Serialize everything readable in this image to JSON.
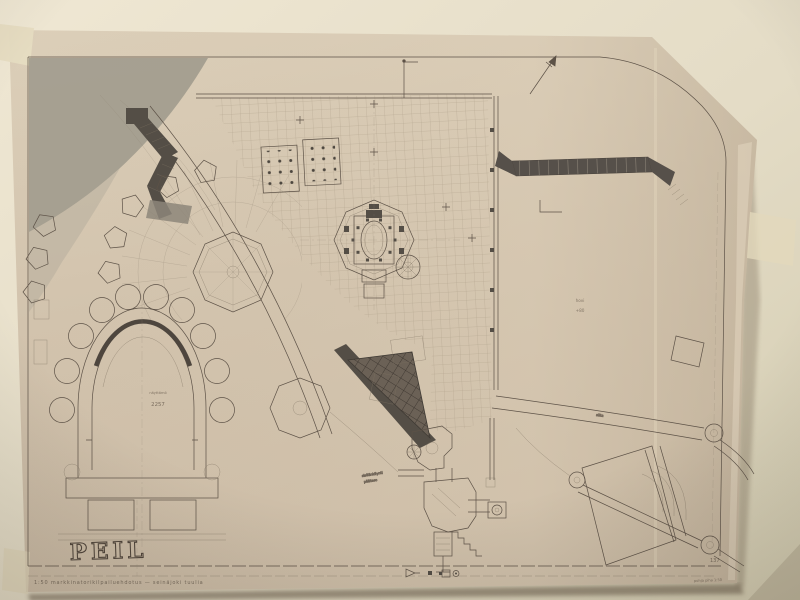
{
  "colors": {
    "wall_top": "#ece4d0",
    "wall_right": "#d8d1b6",
    "paper": "#d2c3ad",
    "paper_light": "#dccfb9",
    "paper_dark": "#c7b8a2",
    "terrain_shade": "#a29c8e",
    "ink": "#5d5247",
    "dark_fill": "#544e46",
    "tape": "#e4dabf"
  },
  "drawing": {
    "title": "PEIL",
    "captions": {
      "bottom_left": "1:50  markkinatorikilpailuehdotus  —  seinäjoki  tuulia",
      "bottom_right": "pohja  piha  1:50",
      "sheet_number": "137"
    },
    "labels": {
      "stage_name": "näyttämö",
      "stage_level": "2257",
      "court_name": "hovi",
      "court_level": "+80",
      "entrance_line1": "sisäänkäynti",
      "entrance_line2": "päätaso",
      "bridge": "silta"
    },
    "icons": {
      "north_arrow": "↗",
      "datum_flag": "⊳",
      "legend_square": "▪",
      "legend_circle": "◦"
    }
  }
}
